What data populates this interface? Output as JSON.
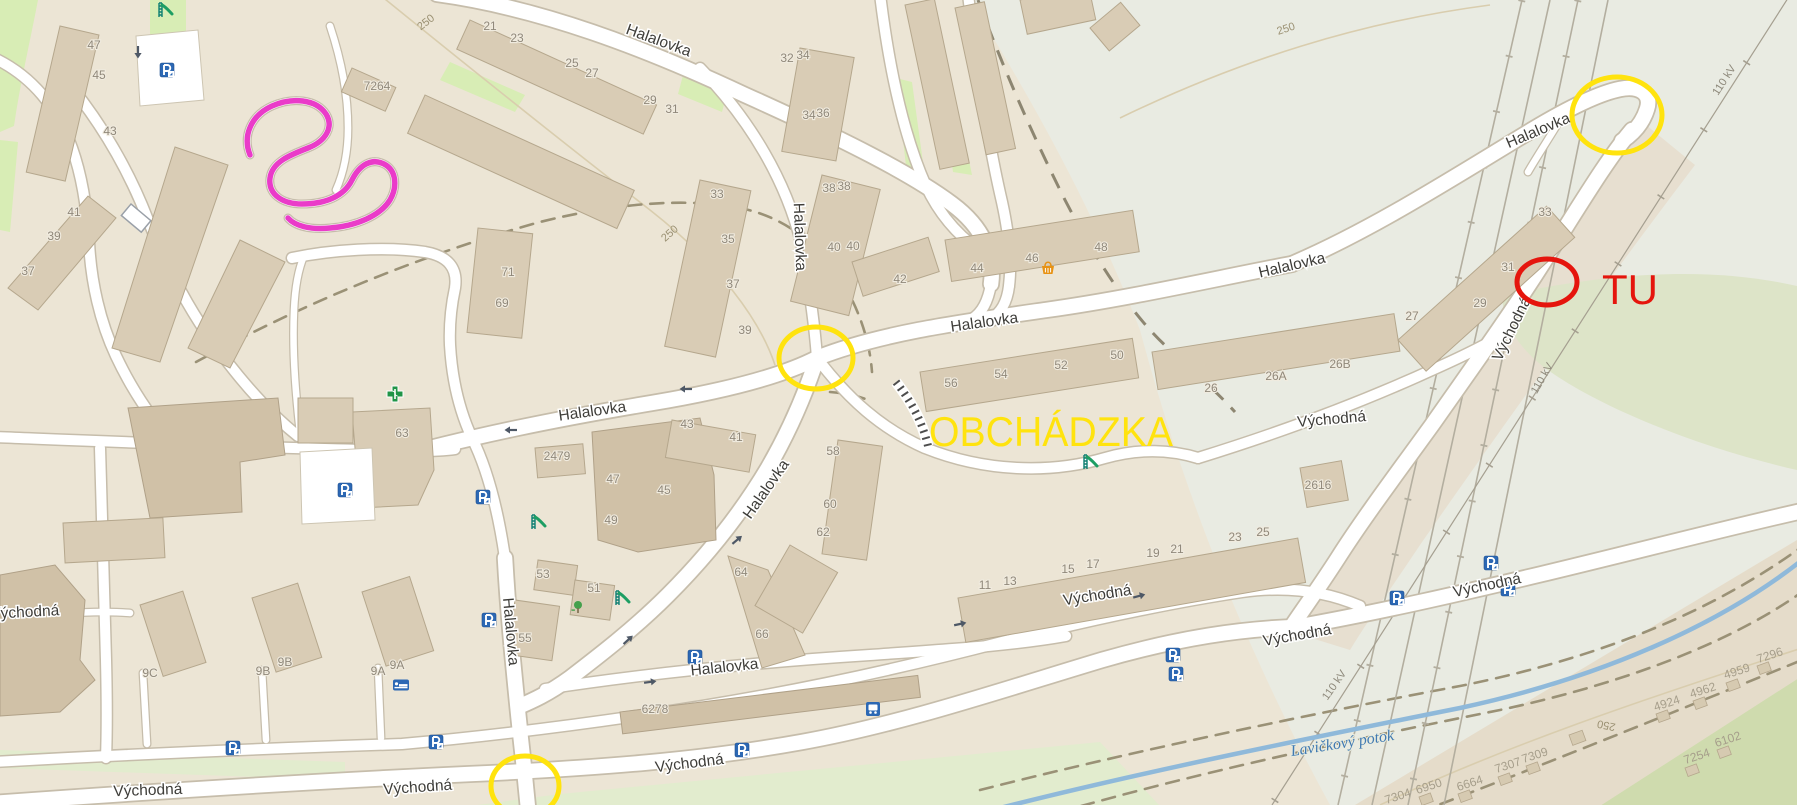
{
  "map_colors": {
    "background": "#ece5d5",
    "outskirts": "#e9ebe2",
    "fields": "#e5dcca",
    "road_fill": "#ffffff",
    "road_casing": "#c6bdab",
    "building": "#d9ccb5",
    "water": "#8fb9da",
    "park_green": "#d8edb5"
  },
  "annotations": {
    "detour_label": {
      "text": "OBCHÁDZKA",
      "x": 1051,
      "y": 446,
      "color": "#ffe30e"
    },
    "here_label": {
      "text": "TU",
      "x": 1630,
      "y": 304,
      "color": "#e5150d"
    },
    "route_color": "#ea3bc9",
    "circles": [
      {
        "name": "detour-endpoint-circle",
        "cx": 1617,
        "cy": 115,
        "rx": 45,
        "ry": 38,
        "color": "#ffe30e"
      },
      {
        "name": "detour-junction-circle-center",
        "cx": 816,
        "cy": 358,
        "rx": 37,
        "ry": 31,
        "color": "#ffe30e"
      },
      {
        "name": "detour-junction-circle-south",
        "cx": 525,
        "cy": 786,
        "rx": 34,
        "ry": 30,
        "color": "#ffe30e"
      },
      {
        "name": "closure-here-circle",
        "cx": 1547,
        "cy": 282,
        "rx": 30,
        "ry": 23,
        "color": "#e5150d"
      }
    ]
  },
  "street_labels": [
    {
      "text": "Halalovka",
      "x": 657,
      "y": 45,
      "rot": 20
    },
    {
      "text": "Halalovka",
      "x": 795,
      "y": 237,
      "rot": 88
    },
    {
      "text": "Halalovka",
      "x": 985,
      "y": 327,
      "rot": -8
    },
    {
      "text": "Halalovka",
      "x": 593,
      "y": 416,
      "rot": -8
    },
    {
      "text": "Halalovka",
      "x": 770,
      "y": 492,
      "rot": -55
    },
    {
      "text": "Halalovka",
      "x": 506,
      "y": 632,
      "rot": 85
    },
    {
      "text": "Halalovka",
      "x": 725,
      "y": 672,
      "rot": -6
    },
    {
      "text": "Halalovka",
      "x": 1540,
      "y": 135,
      "rot": -23
    },
    {
      "text": "Halalovka",
      "x": 1293,
      "y": 270,
      "rot": -13
    },
    {
      "text": "Východná",
      "x": 25,
      "y": 617,
      "rot": -3
    },
    {
      "text": "Východná",
      "x": 148,
      "y": 795,
      "rot": -2
    },
    {
      "text": "Východná",
      "x": 418,
      "y": 792,
      "rot": -4
    },
    {
      "text": "Východná",
      "x": 690,
      "y": 768,
      "rot": -7
    },
    {
      "text": "Východná",
      "x": 1098,
      "y": 600,
      "rot": -9
    },
    {
      "text": "Východná",
      "x": 1332,
      "y": 424,
      "rot": -5
    },
    {
      "text": "Východná",
      "x": 1516,
      "y": 331,
      "rot": -64
    },
    {
      "text": "Východná",
      "x": 1488,
      "y": 590,
      "rot": -12
    },
    {
      "text": "Východná",
      "x": 1298,
      "y": 640,
      "rot": -10
    }
  ],
  "building_numbers": [
    {
      "text": "47",
      "x": 94,
      "y": 49
    },
    {
      "text": "45",
      "x": 99,
      "y": 79
    },
    {
      "text": "43",
      "x": 110,
      "y": 135
    },
    {
      "text": "7264",
      "x": 377,
      "y": 90
    },
    {
      "text": "41",
      "x": 74,
      "y": 216
    },
    {
      "text": "39",
      "x": 54,
      "y": 240
    },
    {
      "text": "37",
      "x": 28,
      "y": 275
    },
    {
      "text": "21",
      "x": 490,
      "y": 30
    },
    {
      "text": "23",
      "x": 517,
      "y": 42
    },
    {
      "text": "25",
      "x": 572,
      "y": 67
    },
    {
      "text": "27",
      "x": 592,
      "y": 77
    },
    {
      "text": "29",
      "x": 650,
      "y": 104
    },
    {
      "text": "31",
      "x": 672,
      "y": 113
    },
    {
      "text": "32",
      "x": 787,
      "y": 62
    },
    {
      "text": "34",
      "x": 803,
      "y": 59
    },
    {
      "text": "34",
      "x": 809,
      "y": 119
    },
    {
      "text": "36",
      "x": 823,
      "y": 117
    },
    {
      "text": "38",
      "x": 829,
      "y": 192
    },
    {
      "text": "38",
      "x": 844,
      "y": 190
    },
    {
      "text": "40",
      "x": 834,
      "y": 251
    },
    {
      "text": "40",
      "x": 853,
      "y": 250
    },
    {
      "text": "42",
      "x": 900,
      "y": 283
    },
    {
      "text": "44",
      "x": 977,
      "y": 272
    },
    {
      "text": "46",
      "x": 1032,
      "y": 262
    },
    {
      "text": "48",
      "x": 1101,
      "y": 251
    },
    {
      "text": "33",
      "x": 717,
      "y": 198
    },
    {
      "text": "35",
      "x": 728,
      "y": 243
    },
    {
      "text": "37",
      "x": 733,
      "y": 288
    },
    {
      "text": "39",
      "x": 745,
      "y": 334
    },
    {
      "text": "71",
      "x": 508,
      "y": 276
    },
    {
      "text": "69",
      "x": 502,
      "y": 307
    },
    {
      "text": "43",
      "x": 687,
      "y": 428
    },
    {
      "text": "41",
      "x": 736,
      "y": 441
    },
    {
      "text": "63",
      "x": 402,
      "y": 437
    },
    {
      "text": "2479",
      "x": 557,
      "y": 460
    },
    {
      "text": "47",
      "x": 613,
      "y": 483
    },
    {
      "text": "45",
      "x": 664,
      "y": 494
    },
    {
      "text": "49",
      "x": 611,
      "y": 524
    },
    {
      "text": "51",
      "x": 594,
      "y": 592
    },
    {
      "text": "53",
      "x": 543,
      "y": 578
    },
    {
      "text": "55",
      "x": 525,
      "y": 642
    },
    {
      "text": "58",
      "x": 833,
      "y": 455
    },
    {
      "text": "60",
      "x": 830,
      "y": 508
    },
    {
      "text": "62",
      "x": 823,
      "y": 536
    },
    {
      "text": "64",
      "x": 741,
      "y": 576
    },
    {
      "text": "66",
      "x": 762,
      "y": 638
    },
    {
      "text": "56",
      "x": 951,
      "y": 387
    },
    {
      "text": "54",
      "x": 1001,
      "y": 378
    },
    {
      "text": "52",
      "x": 1061,
      "y": 369
    },
    {
      "text": "50",
      "x": 1117,
      "y": 359
    },
    {
      "text": "26",
      "x": 1211,
      "y": 392
    },
    {
      "text": "26A",
      "x": 1276,
      "y": 380
    },
    {
      "text": "26B",
      "x": 1340,
      "y": 368
    },
    {
      "text": "27",
      "x": 1412,
      "y": 320
    },
    {
      "text": "29",
      "x": 1480,
      "y": 307
    },
    {
      "text": "31",
      "x": 1508,
      "y": 271
    },
    {
      "text": "33",
      "x": 1545,
      "y": 216
    },
    {
      "text": "2616",
      "x": 1318,
      "y": 489
    },
    {
      "text": "6278",
      "x": 655,
      "y": 713
    },
    {
      "text": "11",
      "x": 985,
      "y": 589
    },
    {
      "text": "13",
      "x": 1010,
      "y": 585
    },
    {
      "text": "15",
      "x": 1068,
      "y": 573
    },
    {
      "text": "17",
      "x": 1093,
      "y": 568
    },
    {
      "text": "19",
      "x": 1153,
      "y": 557
    },
    {
      "text": "21",
      "x": 1177,
      "y": 553
    },
    {
      "text": "23",
      "x": 1235,
      "y": 541
    },
    {
      "text": "25",
      "x": 1263,
      "y": 536
    },
    {
      "text": "9C",
      "x": 150,
      "y": 677
    },
    {
      "text": "9B",
      "x": 263,
      "y": 675
    },
    {
      "text": "9B",
      "x": 285,
      "y": 666
    },
    {
      "text": "9A",
      "x": 378,
      "y": 675
    },
    {
      "text": "9A",
      "x": 397,
      "y": 669
    }
  ],
  "parcel_numbers": [
    {
      "text": "7296",
      "x": 1771,
      "y": 659,
      "rot": -18
    },
    {
      "text": "4959",
      "x": 1738,
      "y": 675,
      "rot": -18
    },
    {
      "text": "4962",
      "x": 1704,
      "y": 694,
      "rot": -18
    },
    {
      "text": "4924",
      "x": 1668,
      "y": 707,
      "rot": -18
    },
    {
      "text": "6102",
      "x": 1729,
      "y": 743,
      "rot": -18
    },
    {
      "text": "7254",
      "x": 1698,
      "y": 760,
      "rot": -18
    },
    {
      "text": "7309",
      "x": 1536,
      "y": 759,
      "rot": -18
    },
    {
      "text": "7307",
      "x": 1509,
      "y": 769,
      "rot": -18
    },
    {
      "text": "6664",
      "x": 1471,
      "y": 787,
      "rot": -18
    },
    {
      "text": "6950",
      "x": 1430,
      "y": 790,
      "rot": -18
    },
    {
      "text": "7304",
      "x": 1399,
      "y": 800,
      "rot": -18
    }
  ],
  "contour_labels": [
    {
      "text": "250",
      "x": 428,
      "y": 25,
      "rot": -38
    },
    {
      "text": "250",
      "x": 672,
      "y": 236,
      "rot": -42
    },
    {
      "text": "250",
      "x": 1287,
      "y": 32,
      "rot": -18
    },
    {
      "text": "250",
      "x": 1607,
      "y": 722,
      "rot": 192
    }
  ],
  "power_labels": [
    {
      "text": "110 kV",
      "x": 1727,
      "y": 82,
      "rot": -57
    },
    {
      "text": "110 kV",
      "x": 1545,
      "y": 380,
      "rot": -60
    },
    {
      "text": "110 kV",
      "x": 1337,
      "y": 687,
      "rot": -55
    }
  ],
  "water_label": {
    "text": "Lavičkový potok",
    "x": 1343,
    "y": 748,
    "rot": -9
  },
  "icons": [
    {
      "type": "parking",
      "x": 167,
      "y": 70,
      "poi": true
    },
    {
      "type": "parking",
      "x": 345,
      "y": 490,
      "poi": true
    },
    {
      "type": "parking",
      "x": 483,
      "y": 497,
      "poi": true
    },
    {
      "type": "parking",
      "x": 489,
      "y": 620,
      "poi": true
    },
    {
      "type": "parking",
      "x": 695,
      "y": 657,
      "poi": true
    },
    {
      "type": "parking",
      "x": 233,
      "y": 748,
      "poi": true
    },
    {
      "type": "parking",
      "x": 436,
      "y": 742,
      "poi": true
    },
    {
      "type": "parking",
      "x": 742,
      "y": 750,
      "poi": true
    },
    {
      "type": "parking",
      "x": 1173,
      "y": 655,
      "poi": true
    },
    {
      "type": "parking",
      "x": 1176,
      "y": 674,
      "poi": true
    },
    {
      "type": "parking",
      "x": 1397,
      "y": 598,
      "poi": true
    },
    {
      "type": "parking",
      "x": 1491,
      "y": 563,
      "poi": true
    },
    {
      "type": "parking",
      "x": 1508,
      "y": 589,
      "poi": true
    },
    {
      "type": "pharmacy",
      "x": 395,
      "y": 394,
      "poi": true
    },
    {
      "type": "playground",
      "x": 165,
      "y": 10,
      "poi": true
    },
    {
      "type": "playground",
      "x": 538,
      "y": 522,
      "poi": true
    },
    {
      "type": "playground",
      "x": 622,
      "y": 598,
      "poi": true
    },
    {
      "type": "playground",
      "x": 1090,
      "y": 462,
      "poi": true
    },
    {
      "type": "tree",
      "x": 578,
      "y": 607,
      "poi": true
    },
    {
      "type": "basket",
      "x": 1048,
      "y": 268,
      "poi": true
    },
    {
      "type": "bed",
      "x": 401,
      "y": 685,
      "poi": true
    },
    {
      "type": "bus",
      "x": 873,
      "y": 709,
      "poi": true
    },
    {
      "type": "oneway-arrow",
      "x": 138,
      "y": 52,
      "rot": 90,
      "poi": false
    },
    {
      "type": "oneway-arrow",
      "x": 686,
      "y": 389,
      "rot": 180,
      "poi": false
    },
    {
      "type": "oneway-arrow",
      "x": 511,
      "y": 430,
      "rot": 180,
      "poi": false
    },
    {
      "type": "oneway-arrow",
      "x": 628,
      "y": 640,
      "rot": -42,
      "poi": false
    },
    {
      "type": "oneway-arrow",
      "x": 737,
      "y": 540,
      "rot": -40,
      "poi": false
    },
    {
      "type": "oneway-arrow",
      "x": 650,
      "y": 682,
      "rot": -8,
      "poi": false
    },
    {
      "type": "oneway-arrow",
      "x": 960,
      "y": 624,
      "rot": -12,
      "poi": false
    },
    {
      "type": "oneway-arrow",
      "x": 1139,
      "y": 596,
      "rot": -15,
      "poi": false
    }
  ]
}
